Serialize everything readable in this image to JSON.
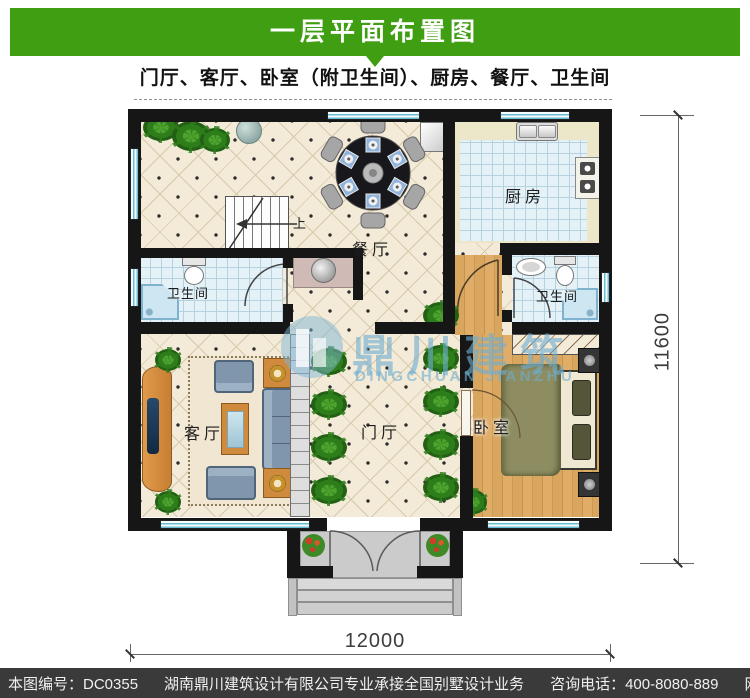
{
  "header": {
    "title": "一层平面布置图"
  },
  "subtitle": "门厅、客厅、卧室（附卫生间）、厨房、餐厅、卫生间",
  "rooms": {
    "dining": "餐厅",
    "kitchen": "厨房",
    "bath_left": "卫生间",
    "bath_right": "卫生间",
    "living": "客厅",
    "hall": "门厅",
    "bedroom": "卧室",
    "stairs_up_label": "上"
  },
  "dimensions": {
    "bottom": "12000",
    "right": "11600"
  },
  "watermark": {
    "title": "鼎川建筑",
    "subtitle": "DINGCHUAN JIANZHU"
  },
  "footer": {
    "serial": "本图编号：DC0355",
    "company": "湖南鼎川建筑设计有限公司专业承接全国别墅设计业务",
    "phone": "咨询电话：400-8080-889",
    "website": "网址：www.bstzcs.com"
  },
  "colors": {
    "header_green": "#3f9e11",
    "footer_bg": "#3a3a3a",
    "wall": "#161616",
    "window_blue": "#69bcd3",
    "watermark_blue": "#7db4d8"
  }
}
